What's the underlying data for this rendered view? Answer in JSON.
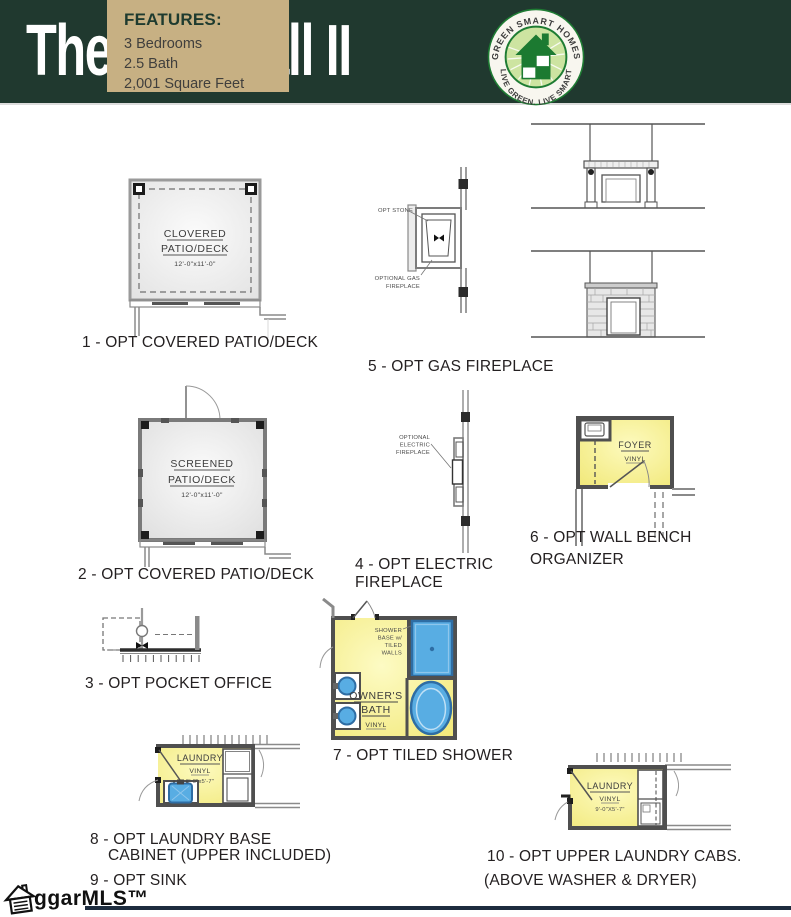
{
  "header": {
    "title": "The Crestfall II",
    "features_title": "FEATURES:",
    "features_items": [
      "3 Bedrooms",
      "2.5 Bath",
      "2,001 Square Feet"
    ],
    "logo_arc_top": "GREEN SMART HOMES",
    "logo_arc_bottom": "LIVE GREEN. LIVE SMART"
  },
  "colors": {
    "header_bg": "#20392f",
    "features_bg": "#c7b083",
    "logo_green": "#1e7c33",
    "room_yellow": "#f6ef90",
    "fixture_blue": "#58ade3",
    "wall_gray": "#4f4f4f",
    "footer_bar": "#1d2c3e"
  },
  "diagrams": {
    "d1": {
      "caption": "1 - OPT COVERED PATIO/DECK",
      "line1": "CLOVERED",
      "line2": "PATIO/DECK",
      "dims": "12'-0\"x11'-0\""
    },
    "d2": {
      "caption": "2 - OPT COVERED PATIO/DECK",
      "line1": "SCREENED",
      "line2": "PATIO/DECK",
      "dims": "12'-0\"x11'-0\""
    },
    "d3": {
      "caption": "3 - OPT POCKET OFFICE"
    },
    "d4": {
      "caption1": "4 - OPT ELECTRIC",
      "caption2": "FIREPLACE",
      "label1": "OPTIONAL",
      "label2": "ELECTRIC",
      "label3": "FIREPLACE"
    },
    "d5": {
      "caption": "5 - OPT GAS FIREPLACE",
      "stone_label": "OPT STONE",
      "gas_label1": "OPTIONAL GAS",
      "gas_label2": "FIREPLACE"
    },
    "d6": {
      "caption1": "6 - OPT WALL BENCH",
      "caption2": "ORGANIZER",
      "room": "FOYER",
      "floor": "VINYL"
    },
    "d7": {
      "caption": "7 - OPT TILED SHOWER",
      "room1": "OWNER'S",
      "room2": "BATH",
      "floor": "VINYL",
      "shower1": "SHOWER",
      "shower2": "BASE w/",
      "shower3": "TILED",
      "shower4": "WALLS"
    },
    "d8": {
      "caption1": "8 - OPT LAUNDRY BASE",
      "caption2": "CABINET (UPPER INCLUDED)",
      "room": "LAUNDRY",
      "floor": "VINYL",
      "dims": "9'-0\"x5'-7\""
    },
    "d9": {
      "caption": "9 - OPT SINK"
    },
    "d10": {
      "caption1": "10 - OPT UPPER LAUNDRY CABS.",
      "caption2": "(ABOVE WASHER & DRYER)",
      "room": "LAUNDRY",
      "floor": "VINYL",
      "dims": "9'-0\"X5'-7\""
    }
  },
  "footer": {
    "brand": "ggarMLS™"
  }
}
